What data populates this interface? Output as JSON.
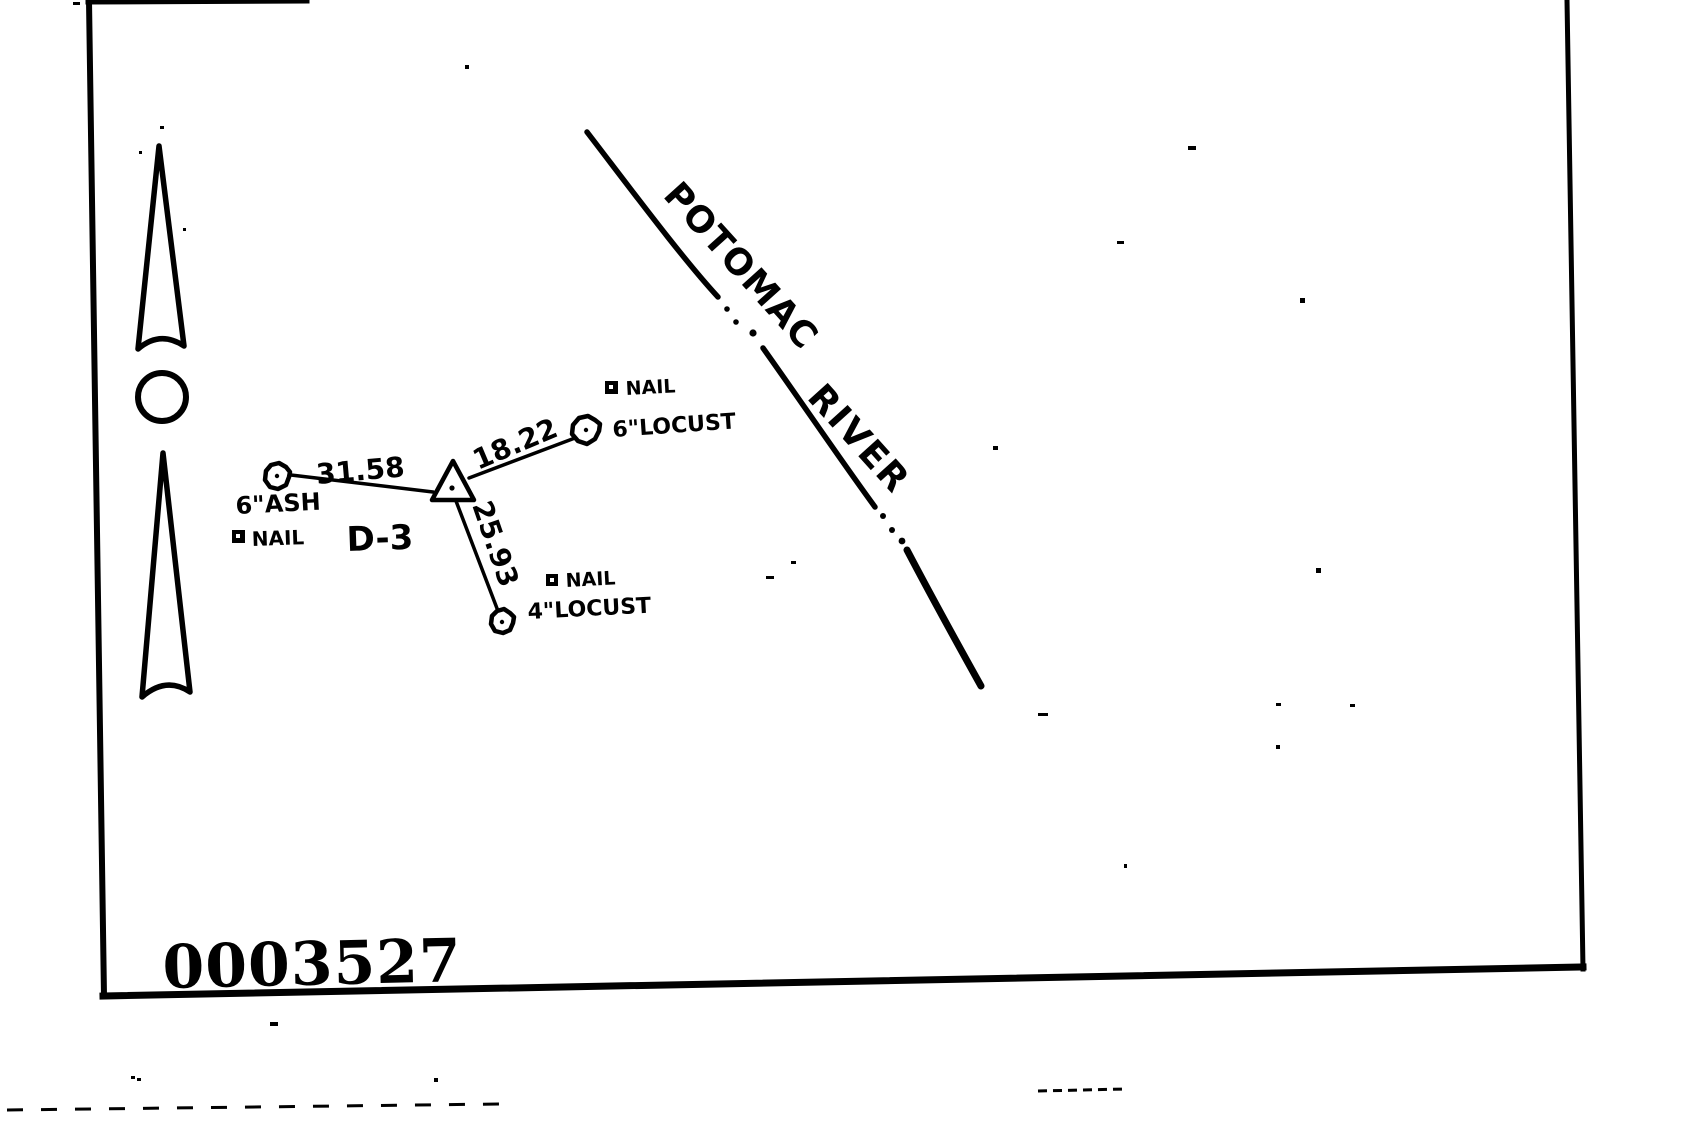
{
  "document": {
    "stamp_number": "0003527"
  },
  "ink": {
    "color": "#000000",
    "paper": "#ffffff"
  },
  "river": {
    "word1": "POTOMAC",
    "word2": "RIVER"
  },
  "station": {
    "id": "D-3",
    "references": [
      {
        "tree": "6\"ASH",
        "nail_label": "NAIL",
        "distance": "31.58"
      },
      {
        "tree": "6\"LOCUST",
        "nail_label": "NAIL",
        "distance": "18.22"
      },
      {
        "tree": "4\"LOCUST",
        "nail_label": "NAIL",
        "distance": "25.93"
      }
    ]
  },
  "icons": {
    "north_arrow": "north-arrow-icon",
    "station_marker": "station-triangle-icon",
    "tree_symbol": "tree-blob-icon",
    "nail_marker": "nail-square-icon"
  }
}
